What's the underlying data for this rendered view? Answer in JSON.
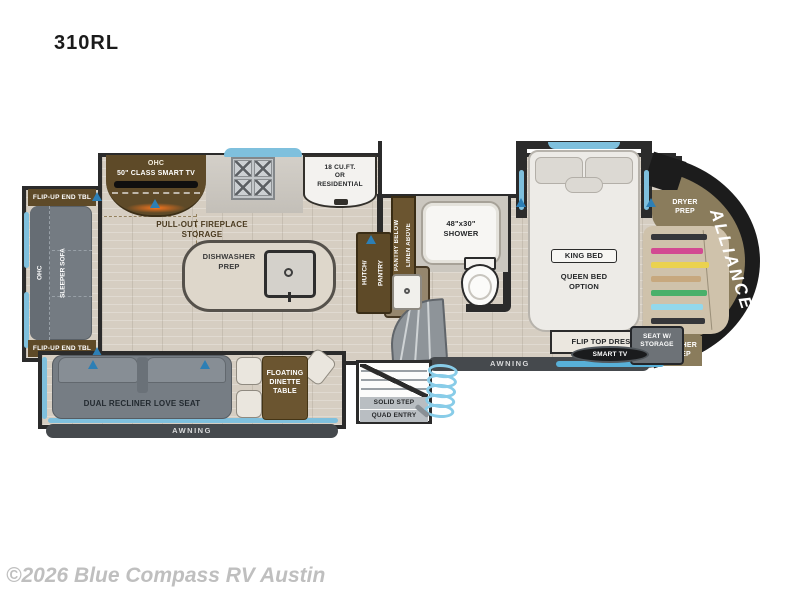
{
  "page": {
    "model": "310RL",
    "watermark": "©2026 Blue Compass RV Austin"
  },
  "colors": {
    "wall": "#2b2b2b",
    "floor": "#d6cec2",
    "cabinet_brown": "#5e4a28",
    "furniture_gray": "#767d84",
    "window_blue": "#7fc0dd",
    "awning_bar": "#45494d",
    "front_cap_olive": "#8a7c5c",
    "tv_strip_blue": "#58b0d8",
    "vent_blue": "#2d7fb5",
    "fireplace_glow_orange": "#ff7820",
    "closet_clothes": [
      "#35363a",
      "#d24a92",
      "#ead24f",
      "#c7a87e",
      "#49b06a",
      "#93d8ec",
      "#35363a"
    ]
  },
  "floorplan": {
    "brand": "ALLIANCE",
    "rear_slide": {
      "end_table_top": "FLIP-UP END TBL",
      "end_table_bottom": "FLIP-UP END TBL",
      "ohc": "OHC",
      "sleeper_sofa": "SLEEPER SOFA"
    },
    "entertainment": {
      "ohc": "OHC",
      "smart_tv": "50\" CLASS SMART TV",
      "fireplace_lines": [
        "PULL-OUT FIREPLACE",
        "STORAGE"
      ]
    },
    "kitchen": {
      "fridge_lines": [
        "18 CU.FT.",
        "OR",
        "RESIDENTIAL"
      ],
      "island_lines": [
        "DISHWASHER",
        "PREP"
      ],
      "pantry_col1": "PANTRY BELOW",
      "pantry_col2": "LINEN ABOVE",
      "hutch_col1": "HUTCH/",
      "hutch_col2": "PANTRY"
    },
    "bathroom": {
      "shower_lines": [
        "48\"x30\"",
        "SHOWER"
      ]
    },
    "bedroom": {
      "king_bed": "KING BED",
      "queen_lines": [
        "QUEEN BED",
        "OPTION"
      ],
      "dresser": "FLIP TOP DRESSER",
      "smart_tv": "SMART TV",
      "seat_lines": [
        "SEAT W/",
        "STORAGE"
      ]
    },
    "front": {
      "dryer_lines": [
        "DRYER",
        "PREP"
      ],
      "washer_lines": [
        "WASHER",
        "PREP"
      ]
    },
    "living_slide": {
      "loveseat": "DUAL RECLINER LOVE SEAT",
      "dinette_lines": [
        "FLOATING",
        "DINETTE",
        "TABLE"
      ],
      "awning": "AWNING"
    },
    "entry": {
      "awning": "AWNING",
      "step_lines": [
        "SOLID STEP",
        "QUAD ENTRY"
      ]
    }
  }
}
